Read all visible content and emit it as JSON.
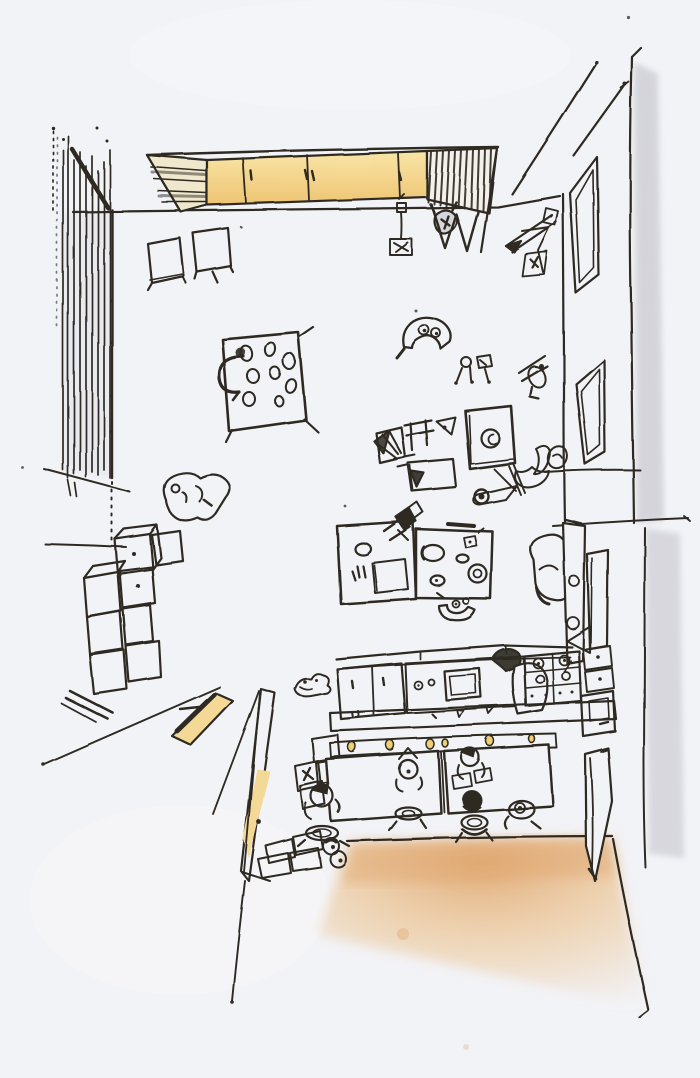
{
  "scene": {
    "type": "hand-drawn interior sketch",
    "view": "overhead fisheye perspective of a classroom / kindergarten room",
    "medium": "black ink pen with yellow and tan colour-pencil highlights",
    "text_content": "none",
    "elements": [
      {
        "name": "top-wall",
        "label": "top wall line"
      },
      {
        "name": "left-curtain-wall",
        "label": "hatched curtain wall, left side"
      },
      {
        "name": "wall-cabinet",
        "label": "long wall cabinet: bookshelf end, yellow sliding doors, dark shelf end"
      },
      {
        "name": "hanging-toy-stand",
        "label": "small stand hanging below top wall"
      },
      {
        "name": "arrow-easel",
        "label": "arrow-like easel sketch near top right corner"
      },
      {
        "name": "stool-cubes",
        "label": "two cube stools below cabinet"
      },
      {
        "name": "paint-table",
        "label": "small table with paint pots and chair arc"
      },
      {
        "name": "crouching-child",
        "label": "child figure crouching at left"
      },
      {
        "name": "storage-cube-pile",
        "label": "pile of storage cubes along left wall"
      },
      {
        "name": "entry-threshold",
        "label": "yellow door threshold, lower left"
      },
      {
        "name": "open-door-left",
        "label": "open door leaf with yellow face, lower left"
      },
      {
        "name": "shoe-rack",
        "label": "shoes and boxes beside the door"
      },
      {
        "name": "craft-table",
        "label": "large double craft table with supplies and leaning child"
      },
      {
        "name": "fruit-bowl",
        "label": "bowl below craft table"
      },
      {
        "name": "toy-scatter",
        "label": "scattered toys, small figures, chair cluster, paper sheet"
      },
      {
        "name": "easel-whiteboard",
        "label": "small easel board with circle doodle"
      },
      {
        "name": "right-wall",
        "label": "right wall with pencil shading"
      },
      {
        "name": "upper-window",
        "label": "upper window on right wall"
      },
      {
        "name": "lower-window",
        "label": "lower window on right wall"
      },
      {
        "name": "corridor-lines",
        "label": "sill and corridor lines at right"
      },
      {
        "name": "tall-easel-divider",
        "label": "tall easel divider with reading chair"
      },
      {
        "name": "kitchen-counter",
        "label": "kitchen counter with sink, stove, drawers and cook figure"
      },
      {
        "name": "serving-bench",
        "label": "serving bench with yellow cups"
      },
      {
        "name": "dining-tables",
        "label": "two dining tables with children on round stools"
      },
      {
        "name": "open-door-right",
        "label": "open door leaf, lower right"
      },
      {
        "name": "floor-shading",
        "label": "tan colour-pencil floor shading at bottom"
      }
    ]
  },
  "colors": {
    "paper": "#f2f3f7",
    "ink": "#2e2a24",
    "cabinet_yellow_light": "#f9e5a6",
    "cabinet_yellow_deep": "#eec573",
    "door_yellow": "#f3d896",
    "cup_yellow": "#f0ce74",
    "floor_tan": "#ecc697",
    "floor_tan_deep": "#e0a76f",
    "pencil_gray": "#b7b7bf",
    "bookshelf_cream": "#efe8cd"
  }
}
